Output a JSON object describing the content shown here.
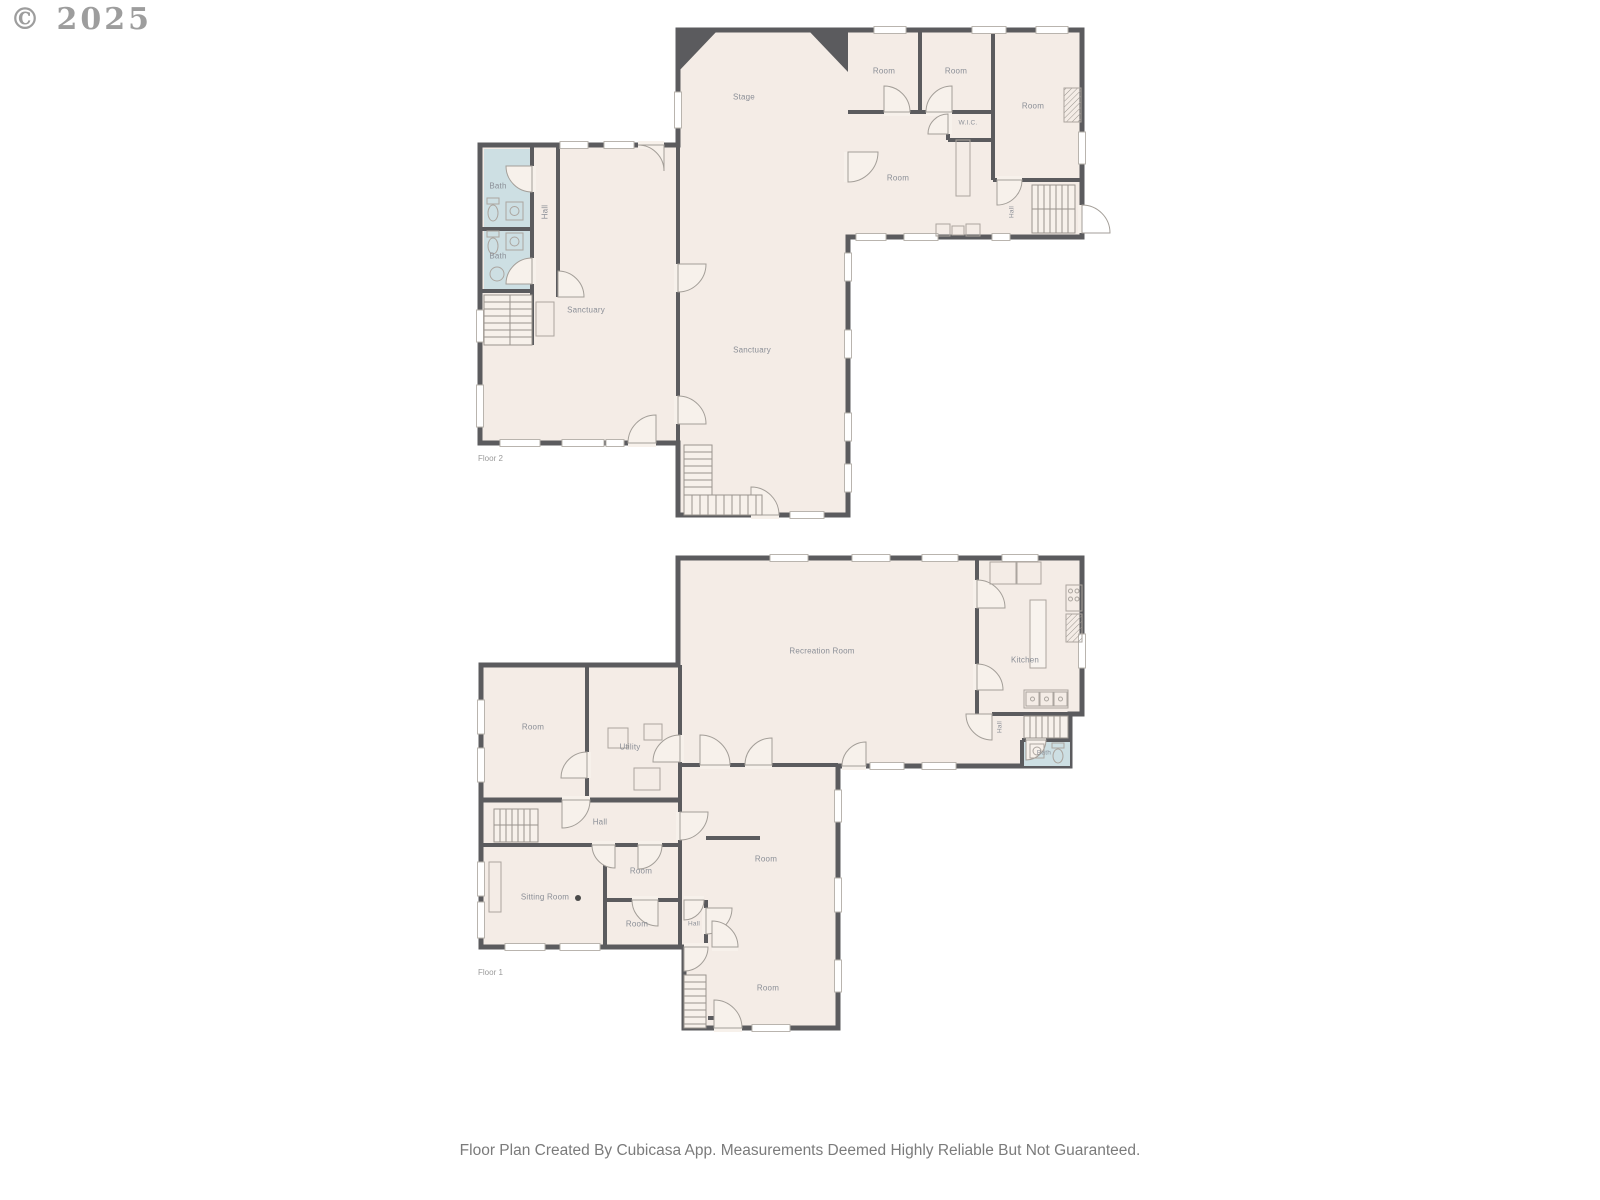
{
  "watermark": "© 2025",
  "footer": "Floor Plan Created By Cubicasa App. Measurements Deemed Highly Reliable But Not Guaranteed.",
  "colors": {
    "wall": "#5b5b5e",
    "room": "#f4ece6",
    "bath": "#cddfe3",
    "label": "#8b8f97"
  },
  "floor2": {
    "label": "Floor 2",
    "rooms": {
      "stage": "Stage",
      "sanctuary_left": "Sanctuary",
      "sanctuary_main": "Sanctuary",
      "bath_upper": "Bath",
      "bath_lower": "Bath",
      "hall_left": "Hall",
      "room_top_a": "Room",
      "room_top_b": "Room",
      "room_right": "Room",
      "wic": "W.I.C.",
      "room_center": "Room",
      "hall_right": "Hall"
    }
  },
  "floor1": {
    "label": "Floor 1",
    "rooms": {
      "recreation": "Recreation Room",
      "kitchen": "Kitchen",
      "hall_kitchen": "Hall",
      "bath": "Bath",
      "room_left": "Room",
      "utility": "Utility",
      "hall_main": "Hall",
      "sitting": "Sitting Room",
      "room_a": "Room",
      "room_b": "Room",
      "hall_small": "Hall",
      "room_center": "Room",
      "room_bottom": "Room"
    }
  }
}
